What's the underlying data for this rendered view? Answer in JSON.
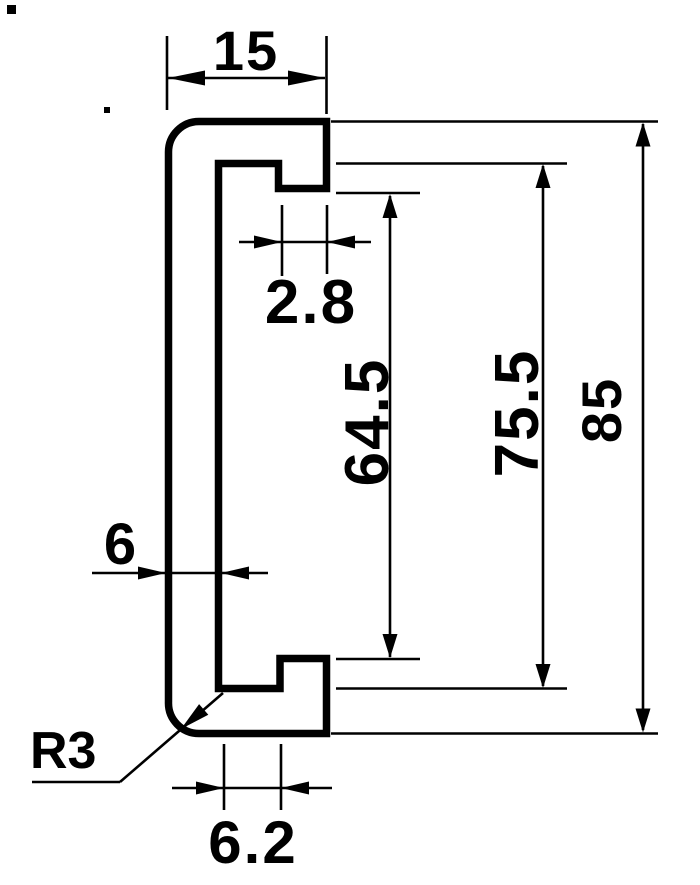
{
  "page": {
    "background": "#ffffff",
    "ink": "#000000"
  },
  "drawing": {
    "kind": "technical-dimension-drawing",
    "subject": "c-channel-profile-cross-section",
    "dimensions": {
      "overall_width": "15",
      "lip_width": "2.8",
      "opening_height": "64.5",
      "inner_height": "75.5",
      "overall_height": "85",
      "web_thickness": "6",
      "corner_radius": "R3",
      "shelf_width": "6.2"
    }
  }
}
